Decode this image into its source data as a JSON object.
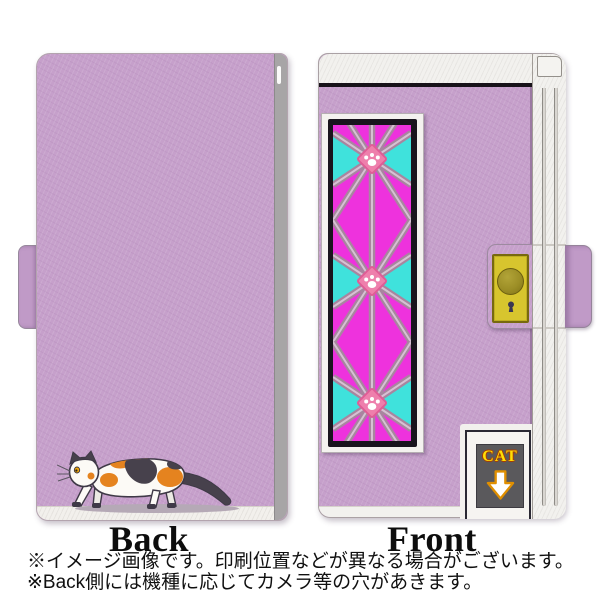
{
  "product": {
    "back_view": {
      "label": "Back"
    },
    "front_view": {
      "label": "Front",
      "flap_label": "CAT"
    },
    "notes": {
      "line1": "※イメージ画像です。印刷位置などが異なる場合がございます。",
      "line2": "※Back側には機種に応じてカメラ等の穴があきます。"
    },
    "colors": {
      "case_lavender": "#c6a0cb",
      "edge_white": "#f2f1ee",
      "back_spine_gray": "#a7a5a6",
      "glass_magenta": "#ee32dd",
      "glass_cyan": "#3fe2dc",
      "lattice_mauve": "#a8859f",
      "lattice_light": "#d6c1d3",
      "paw_medallion_pink": "#ee7fac",
      "clasp_yellow": "#d7c52e",
      "snap_button_olive": "#9c8e26",
      "flap_inner_gray": "#5a595c",
      "flap_text_yellow": "#ffdf05",
      "arrow_orange": "#e08f00",
      "cat_patch_orange": "#e5831f",
      "cat_patch_dark": "#47414c"
    },
    "icons": [
      "calico-cat-illustration",
      "paw-print-medallion",
      "snap-button-icon",
      "keyhole-icon",
      "down-arrow-icon"
    ]
  }
}
